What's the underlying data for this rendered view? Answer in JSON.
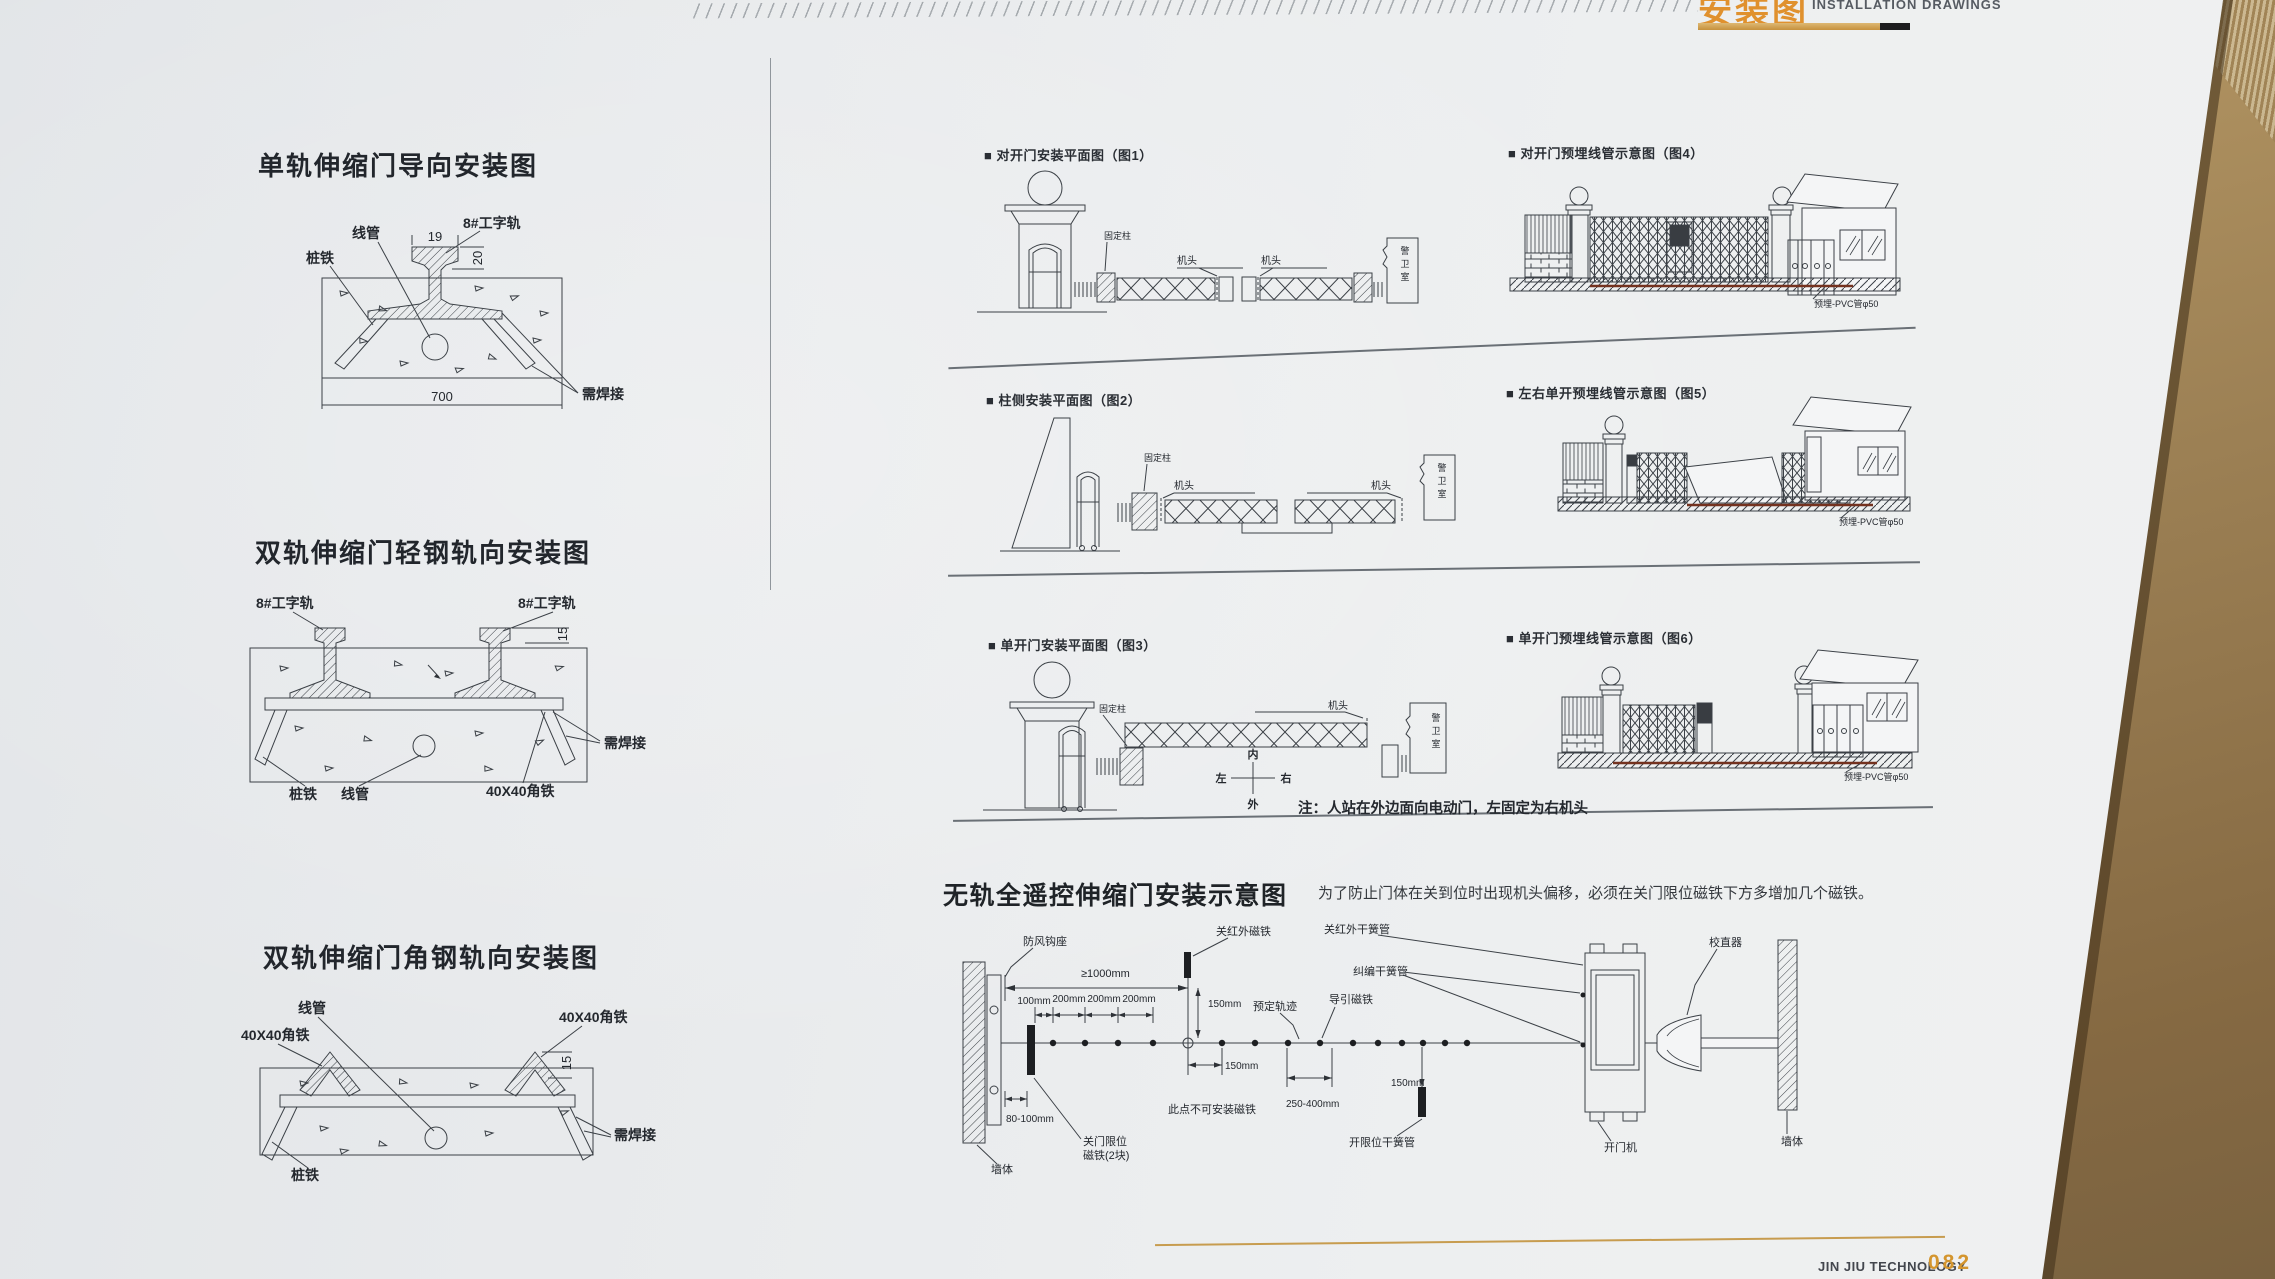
{
  "header": {
    "title_cn": "安装图",
    "title_en": "INSTALLATION DRAWINGS"
  },
  "footer": {
    "brand": "JIN JIU TECHNOLOGY",
    "page_number": "082"
  },
  "left_column": {
    "d1": {
      "title": "单轨伸缩门导向安装图",
      "conduit": "线管",
      "stake": "桩铁",
      "rail": "8#工字轨",
      "weld": "需焊接",
      "dim_width": "700",
      "dim_head": "19",
      "dim_height": "20"
    },
    "d2": {
      "title": "双轨伸缩门轻钢轨向安装图",
      "rail_left": "8#工字轨",
      "rail_right": "8#工字轨",
      "dim_height": "15",
      "weld": "需焊接",
      "stake": "桩铁",
      "conduit": "线管",
      "angle": "40X40角铁"
    },
    "d3": {
      "title": "双轨伸缩门角钢轨向安装图",
      "conduit": "线管",
      "angle_left": "40X40角铁",
      "angle_right": "40X40角铁",
      "dim_height": "15",
      "weld": "需焊接",
      "stake": "桩铁"
    }
  },
  "right_column": {
    "fig1": {
      "caption": "■ 对开门安装平面图（图1）",
      "fixed_post": "固定柱",
      "head_left": "机头",
      "head_right": "机头",
      "guard_room": "警卫室"
    },
    "fig2": {
      "caption": "■ 柱侧安装平面图（图2）",
      "fixed_post": "固定柱",
      "head_left": "机头",
      "head_right": "机头",
      "guard_room": "警卫室"
    },
    "fig3": {
      "caption": "■ 单开门安装平面图（图3）",
      "fixed_post": "固定柱",
      "head": "机头",
      "guard_room": "警卫室",
      "compass_inner": "内",
      "compass_outer": "外",
      "compass_left": "左",
      "compass_right": "右",
      "note": "注：人站在外边面向电动门，左固定为右机头"
    },
    "fig4": {
      "caption": "■ 对开门预埋线管示意图（图4）",
      "pvc": "预埋-PVC管φ50"
    },
    "fig5": {
      "caption": "■ 左右单开预埋线管示意图（图5）",
      "pvc": "预埋-PVC管φ50"
    },
    "fig6": {
      "caption": "■ 单开门预埋线管示意图（图6）",
      "pvc": "预埋-PVC管φ50"
    }
  },
  "bottom": {
    "title": "无轨全遥控伸缩门安装示意图",
    "note": "为了防止门体在关到位时出现机头偏移，必须在关门限位磁铁下方多增加几个磁铁。",
    "wind_hook": "防风钩座",
    "dim_1000": "≥1000mm",
    "close_ir_magnet": "关红外磁铁",
    "close_ir_reed": "关红外干簧管",
    "aligner": "校直器",
    "deviation_reed": "纠编干簧管",
    "dim_100": "100mm",
    "dim_200": "200mm",
    "dim_150": "150mm",
    "track": "预定轨迹",
    "guide_magnet": "导引磁铁",
    "no_magnet_note": "此点不可安装磁铁",
    "dim_250_400": "250-400mm",
    "dim_80_100": "80-100mm",
    "close_limit_line1": "关门限位",
    "close_limit_line2": "磁铁(2块)",
    "open_limit_reed": "开限位干簧管",
    "opener": "开门机",
    "wall": "墙体"
  }
}
